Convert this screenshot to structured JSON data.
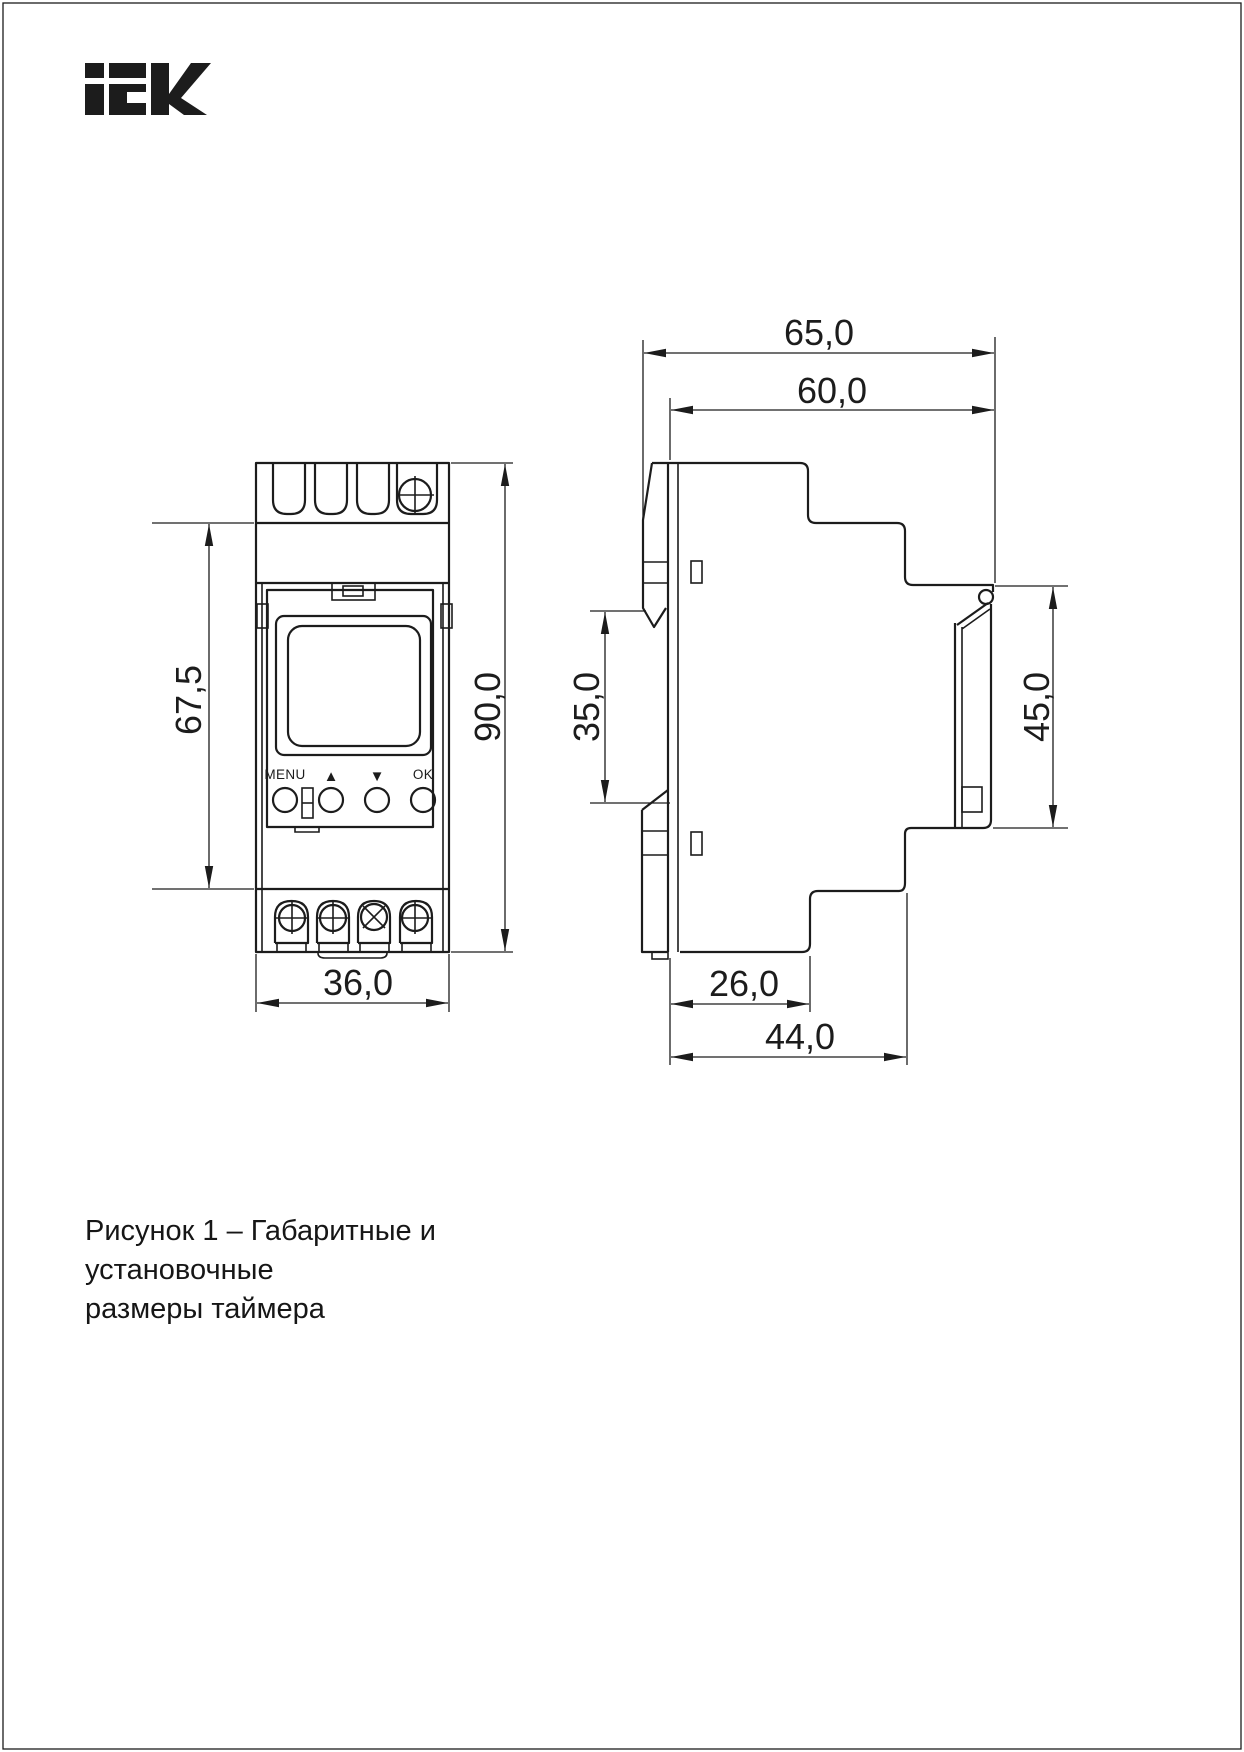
{
  "brand": {
    "logo_text": "IEK"
  },
  "figure": {
    "caption_line1": "Рисунок 1 – Габаритные и установочные",
    "caption_line2": "размеры таймера"
  },
  "front_view": {
    "button_labels": {
      "menu": "MENU",
      "up": "▲",
      "down": "▼",
      "ok": "OK"
    },
    "dimensions": {
      "body_height_mm": "67,5",
      "total_height_mm": "90,0",
      "width_mm": "36,0"
    }
  },
  "side_view": {
    "dimensions": {
      "total_depth_mm": "65,0",
      "body_depth_mm": "60,0",
      "din_rail_slot_mm": "35,0",
      "front_panel_height_mm": "45,0",
      "lower_depth_mm": "26,0",
      "lower_total_depth_mm": "44,0"
    }
  },
  "colors": {
    "line": "#1c1c1c",
    "background": "#ffffff"
  }
}
